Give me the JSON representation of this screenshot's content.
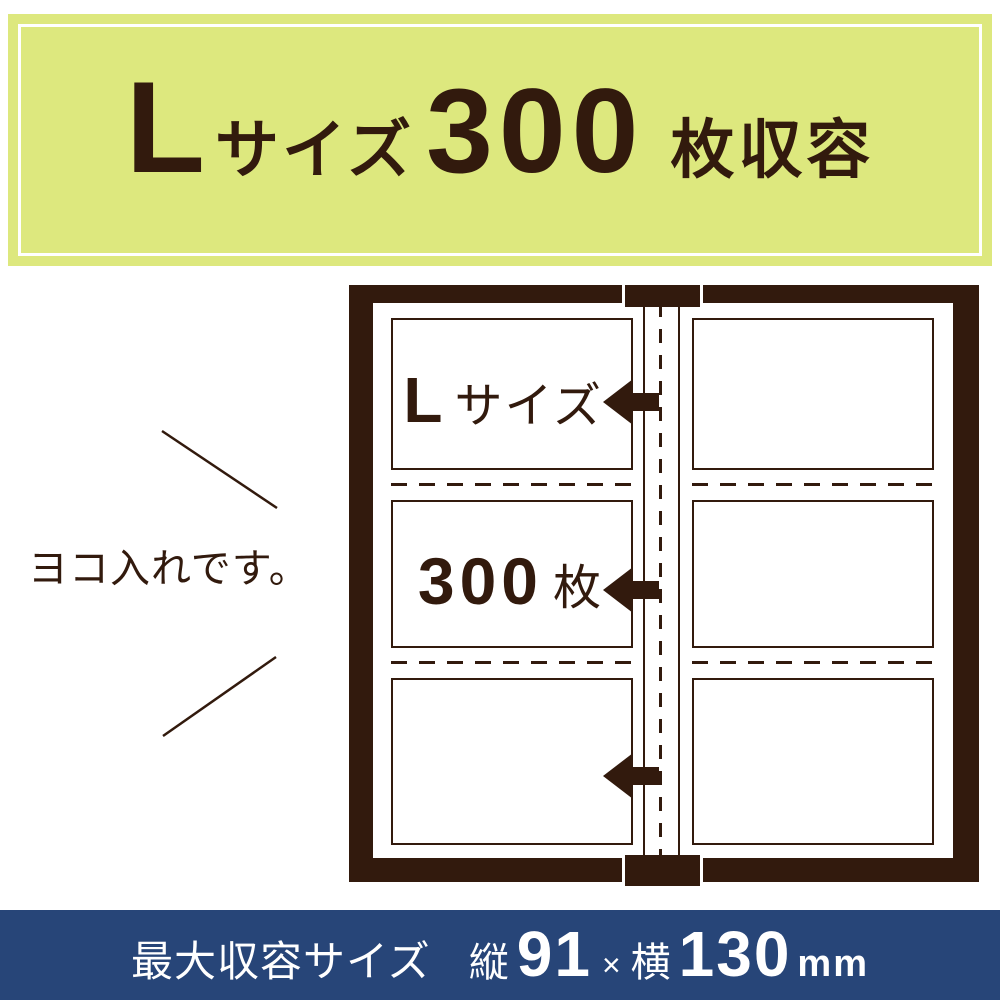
{
  "banner": {
    "size_letter": "L",
    "size_suffix": "サイズ",
    "count": "300",
    "count_suffix": "枚収容"
  },
  "side_note": {
    "text": "ヨコ入れです。"
  },
  "album": {
    "slot1_label": {
      "letter": "L",
      "suffix": "サイズ"
    },
    "slot2_label": {
      "count": "300",
      "unit": "枚"
    }
  },
  "footer": {
    "label": "最大収容サイズ",
    "height_prefix": "縦",
    "height_value": "91",
    "multiply": "×",
    "width_prefix": "横",
    "width_value": "130",
    "unit": "mm"
  },
  "colors": {
    "banner_bg": "#dde87e",
    "text_brown": "#321a0d",
    "footer_navy": "#274578",
    "white": "#ffffff"
  }
}
